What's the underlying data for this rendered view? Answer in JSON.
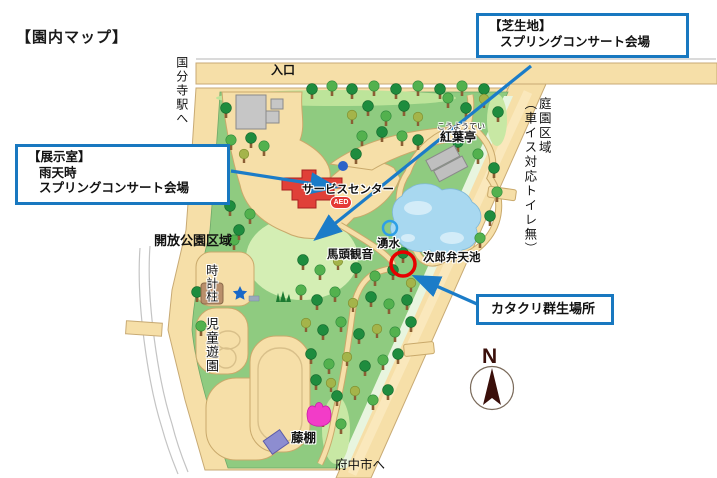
{
  "page_title": "【園内マップ】",
  "colors": {
    "callout_border_blue": "#1878C0",
    "arrow_blue": "#1B7CC8",
    "road_tan": "#F6DFA8",
    "park_green": "#8FCB80",
    "lawn_light_green": "#D4EEB4",
    "pond_blue": "#A8D8F0",
    "service_center_red": "#E04038",
    "aed_red": "#E53935",
    "katakuri_circle_red": "#E60000",
    "spring_circle_blue": "#2E9FE6",
    "compass_brown": "#3A0F0A",
    "building_gray": "#C6C6C6",
    "trellis_purple": "#8D8DD0",
    "tulip_pink": "#F23CC8",
    "star_blue": "#1868C8",
    "clock_pillar_brown": "#B98F6B"
  },
  "callouts": {
    "lawn": {
      "heading": "【芝生地】",
      "body": "スプリングコンサート会場"
    },
    "exhibit_room": {
      "heading": "【展示室】",
      "line1": "雨天時",
      "line2": "スプリングコンサート会場"
    },
    "katakuri": {
      "label": "カタクリ群生場所"
    }
  },
  "labels": {
    "entrance": "入口",
    "to_kokubunji_station": "国分寺駅へ",
    "garden_zone": "庭園区域",
    "garden_zone_note": "（車イス対応トイレ無）",
    "open_park_zone": "開放公園区域",
    "clock_pillar": "時計柱",
    "childrens_playground": "児童遊園",
    "service_center": "サービスセンター",
    "aed": "AED",
    "koyotei_furigana": "こうようてい",
    "koyotei": "紅葉亭",
    "bato_kannon": "馬頭観音",
    "spring_water": "湧水",
    "jiro_benten_pond": "次郎弁天池",
    "wisteria_trellis": "藤棚",
    "to_fuchu_city": "府中市へ",
    "compass_north": "N"
  }
}
